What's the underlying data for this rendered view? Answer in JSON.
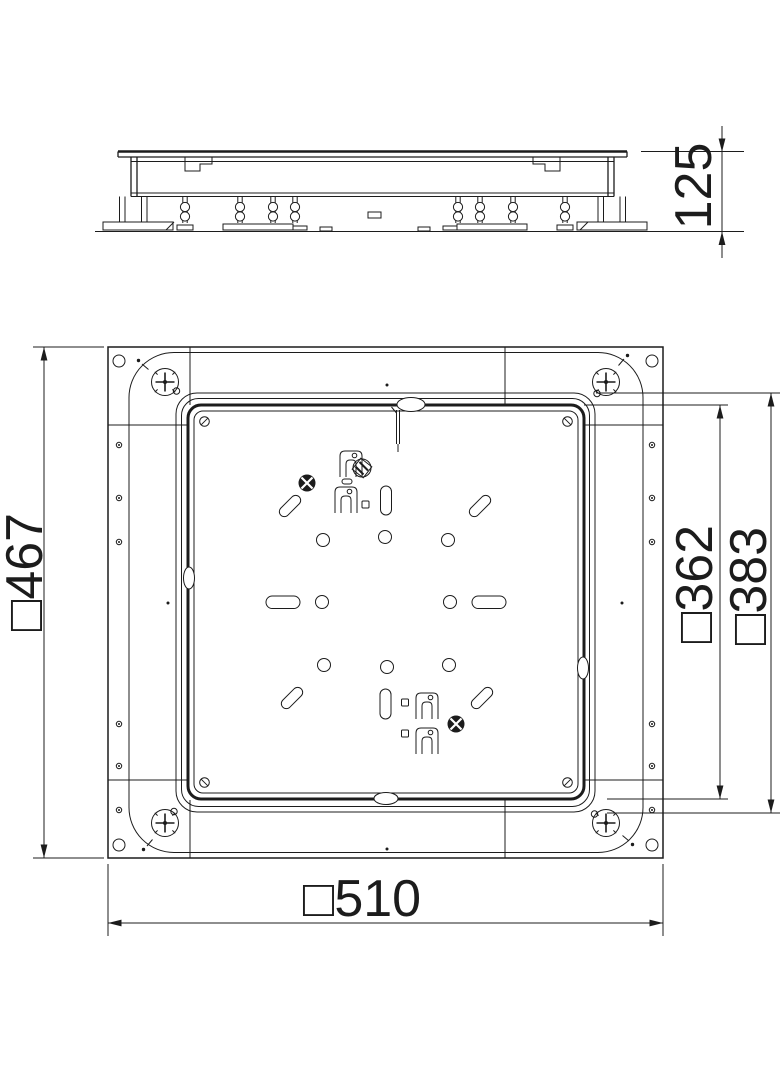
{
  "drawing": {
    "dimensions": {
      "side_view_height": "125",
      "plan_frame_height": "□467",
      "plan_cover_size": "□362",
      "plan_opening_size": "□383",
      "plan_overall_width": "□510"
    },
    "colors": {
      "line": "#1c1c1c",
      "background": "#ffffff"
    }
  }
}
